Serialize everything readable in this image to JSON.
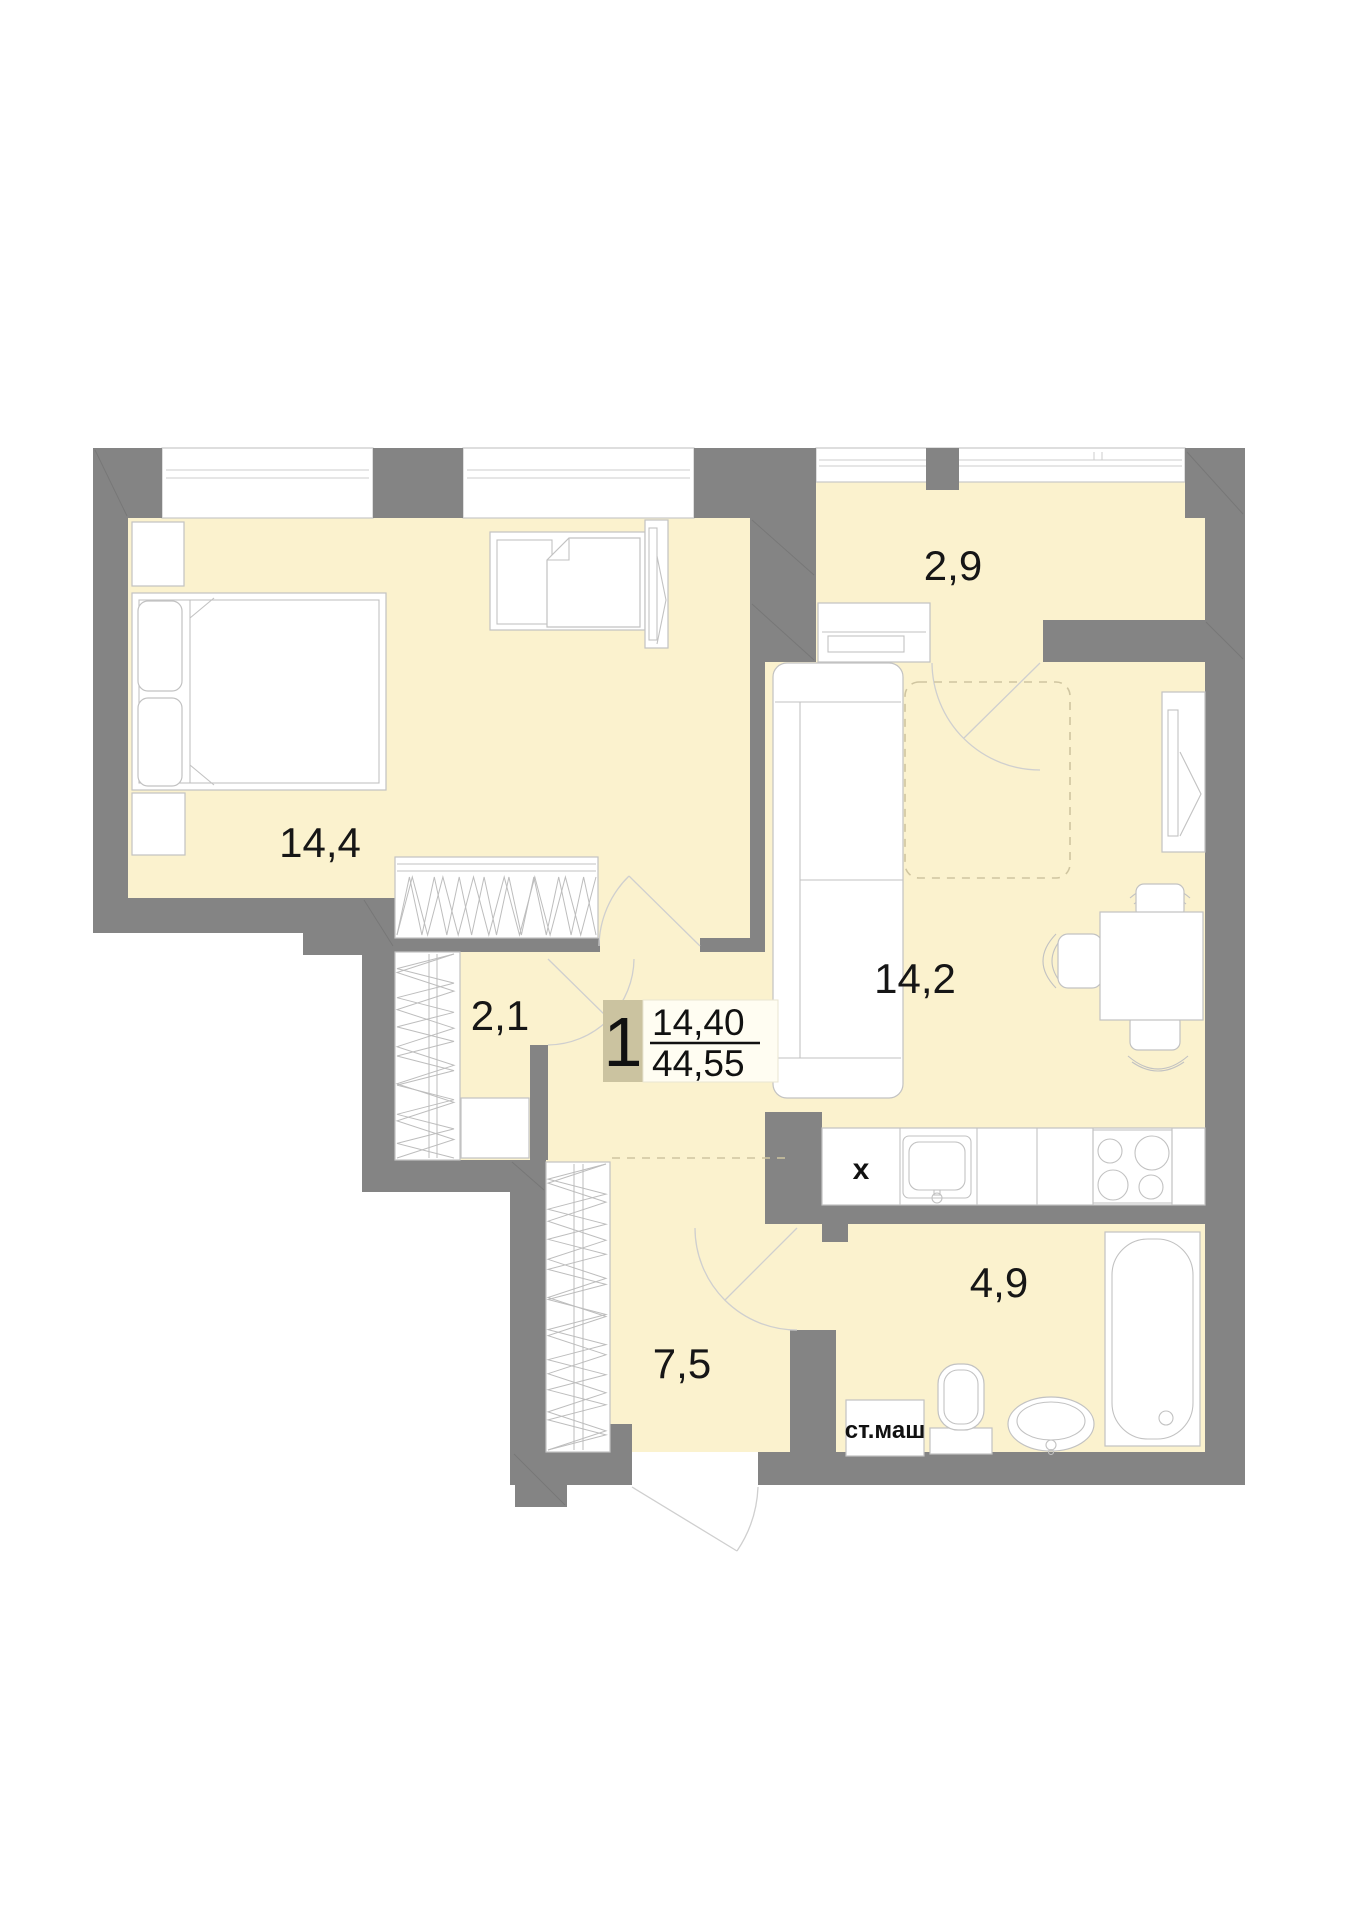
{
  "plan": {
    "unit_badge": {
      "rooms_count": "1",
      "living_area": "14,40",
      "total_area": "44,55"
    },
    "rooms": [
      {
        "id": "bedroom",
        "area_label": "14,4"
      },
      {
        "id": "balcony",
        "area_label": "2,9"
      },
      {
        "id": "living-kitchen",
        "area_label": "14,2"
      },
      {
        "id": "closet",
        "area_label": "2,1"
      },
      {
        "id": "hallway",
        "area_label": "7,5"
      },
      {
        "id": "bathroom",
        "area_label": "4,9"
      }
    ],
    "annotations": {
      "washing_machine": "ст.маш",
      "fridge_marker": "x"
    },
    "colors": {
      "wall": "#848484",
      "floor": "#fbf2ce",
      "paper": "#ffffff",
      "furniture_stroke": "#c2c2c2",
      "dashed_line": "#cfc5a0",
      "badge_background": "#cbc3a0",
      "badge_panel": "#fffdf2",
      "text": "#161616"
    }
  }
}
